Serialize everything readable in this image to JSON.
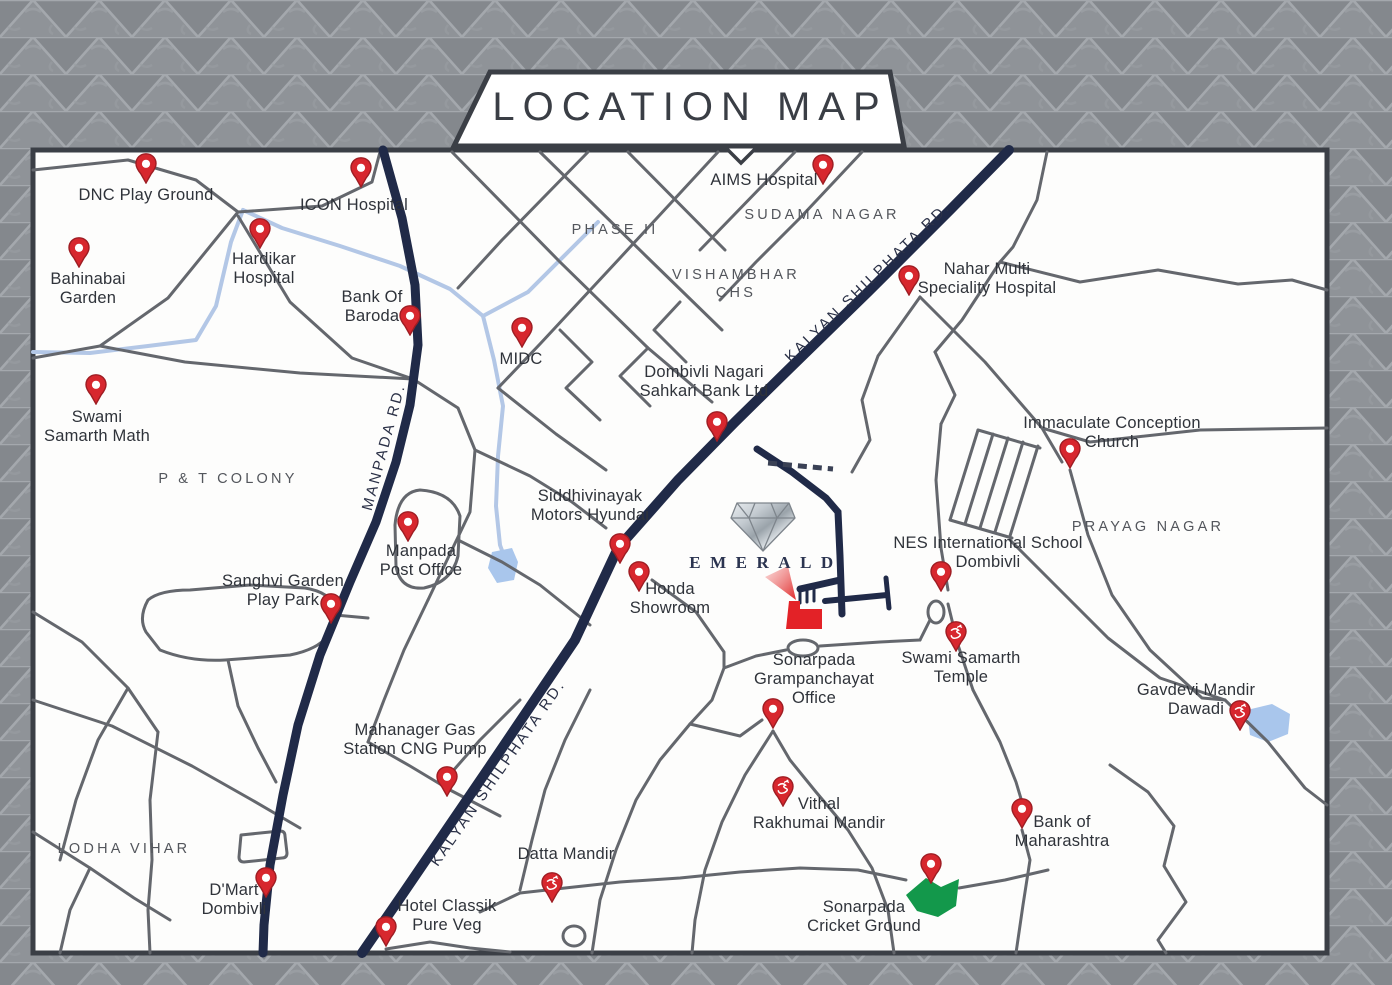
{
  "banner": {
    "title": "LOCATION MAP"
  },
  "project": {
    "name": "EMERALD"
  },
  "colors": {
    "pin_red": "#d7272e",
    "road_navy": "#202a48",
    "cricket_green": "#13984b",
    "river_blue": "#b3c7e6"
  },
  "road_labels": {
    "manpada": "MANPADA RD.",
    "kalyan_top": "KALYAN SHILPHATA RD.",
    "kalyan_bottom": "KALYAN SHILPHATA RD."
  },
  "area_labels": {
    "phase2": "PHASE II",
    "sudama": "SUDAMA NAGAR",
    "vishambhar_line1": "VISHAMBHAR",
    "vishambhar_line2": "CHS",
    "pt_colony": "P & T COLONY",
    "prayag": "PRAYAG NAGAR",
    "lodha": "LODHA VIHAR"
  },
  "pois": [
    {
      "id": "dnc-play-ground",
      "lines": [
        "DNC Play Ground"
      ]
    },
    {
      "id": "icon-hospital",
      "lines": [
        "ICON Hospital"
      ]
    },
    {
      "id": "bahinabai-garden",
      "lines": [
        "Bahinabai",
        "Garden"
      ]
    },
    {
      "id": "hardikar-hospital",
      "lines": [
        "Hardikar",
        "Hospital"
      ]
    },
    {
      "id": "bank-of-baroda",
      "lines": [
        "Bank Of",
        "Baroda"
      ]
    },
    {
      "id": "swami-samarth-math",
      "lines": [
        "Swami",
        "Samarth Math"
      ]
    },
    {
      "id": "aims-hospital",
      "lines": [
        "AIMS Hospital"
      ]
    },
    {
      "id": "nahar-multi-speciality-hospital",
      "lines": [
        "Nahar Multi",
        "Speciality Hospital"
      ]
    },
    {
      "id": "dombivli-nagari-sahkari-bank",
      "lines": [
        "Dombivli Nagari",
        "Sahkari Bank Ltd"
      ]
    },
    {
      "id": "midc",
      "lines": [
        "MIDC"
      ]
    },
    {
      "id": "immaculate-conception-church",
      "lines": [
        "Immaculate Conception",
        "Church"
      ]
    },
    {
      "id": "siddhivinayak-motors-hyundai",
      "lines": [
        "Siddhivinayak",
        "Motors Hyundai"
      ]
    },
    {
      "id": "honda-showroom",
      "lines": [
        "Honda",
        "Showroom"
      ]
    },
    {
      "id": "manpada-post-office",
      "lines": [
        "Manpada",
        "Post Office"
      ]
    },
    {
      "id": "sanghvi-garden-play-park",
      "lines": [
        "Sanghvi Garden",
        "Play Park"
      ]
    },
    {
      "id": "nes-international-school",
      "lines": [
        "NES International School",
        "Dombivli"
      ]
    },
    {
      "id": "swami-samarth-temple",
      "lines": [
        "Swami Samarth",
        "Temple"
      ]
    },
    {
      "id": "gavdevi-mandir-dawadi",
      "lines": [
        "Gavdevi Mandir",
        "Dawadi"
      ]
    },
    {
      "id": "sonarpada-grampanchayat-office",
      "lines": [
        "Sonarpada",
        "Grampanchayat",
        "Office"
      ]
    },
    {
      "id": "mahanager-gas-station",
      "lines": [
        "Mahanager Gas",
        "Station CNG Pump"
      ]
    },
    {
      "id": "vithal-rakhumai-mandir",
      "lines": [
        "Vithal",
        "Rakhumai Mandir"
      ]
    },
    {
      "id": "bank-of-maharashtra",
      "lines": [
        "Bank of",
        "Maharashtra"
      ]
    },
    {
      "id": "dmart-dombivli",
      "lines": [
        "D'Mart",
        "Dombivli"
      ]
    },
    {
      "id": "datta-mandir",
      "lines": [
        "Datta Mandir"
      ]
    },
    {
      "id": "hotel-classik-pure-veg",
      "lines": [
        "Hotel Classik",
        "Pure Veg"
      ]
    },
    {
      "id": "sonarpada-cricket-ground",
      "lines": [
        "Sonarpada",
        "Cricket Ground"
      ]
    }
  ]
}
